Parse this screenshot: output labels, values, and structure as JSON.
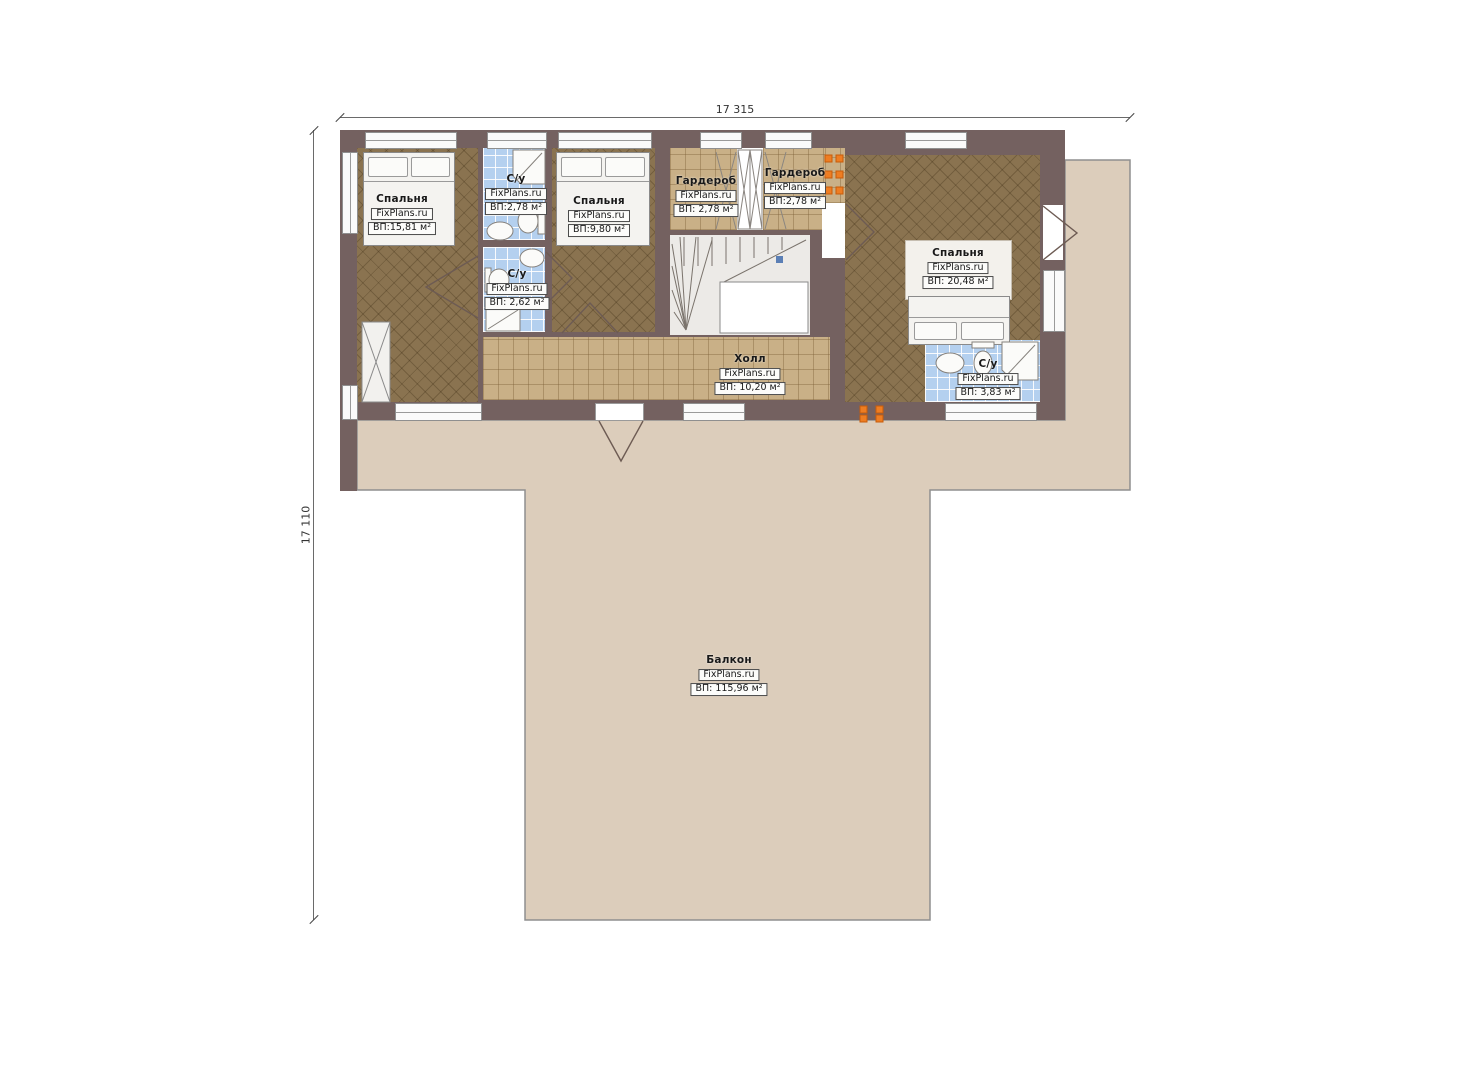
{
  "plan": {
    "source_brand": "FixPlans.ru",
    "dimensions": {
      "width_label": "17 315",
      "height_label": "17 110"
    }
  },
  "rooms": [
    {
      "id": "bedroom-1",
      "name": "Спальня",
      "brand": "FixPlans.ru",
      "area": "ВП:15,81 м²"
    },
    {
      "id": "bathroom-top",
      "name": "С/у",
      "brand": "FixPlans.ru",
      "area": "ВП:2,78 м²"
    },
    {
      "id": "bedroom-2",
      "name": "Спальня",
      "brand": "FixPlans.ru",
      "area": "ВП:9,80 м²"
    },
    {
      "id": "wardrobe-1",
      "name": "Гардероб",
      "brand": "FixPlans.ru",
      "area": "ВП: 2,78 м²"
    },
    {
      "id": "wardrobe-2",
      "name": "Гардероб",
      "brand": "FixPlans.ru",
      "area": "ВП:2,78 м²"
    },
    {
      "id": "bedroom-3",
      "name": "Спальня",
      "brand": "FixPlans.ru",
      "area": "ВП: 20,48 м²"
    },
    {
      "id": "bathroom-mid",
      "name": "С/у",
      "brand": "FixPlans.ru",
      "area": "ВП: 2,62 м²"
    },
    {
      "id": "hall",
      "name": "Холл",
      "brand": "FixPlans.ru",
      "area": "ВП: 10,20 м²"
    },
    {
      "id": "bathroom-right",
      "name": "С/у",
      "brand": "FixPlans.ru",
      "area": "ВП: 3,83 м²"
    },
    {
      "id": "balcony",
      "name": "Балкон",
      "brand": "FixPlans.ru",
      "area": "ВП: 115,96 м²"
    }
  ],
  "colors": {
    "wall": "#746160",
    "wood_floor": "#8a7350",
    "tile_floor_tan": "#c9b087",
    "tile_floor_blue": "#b4d0ef",
    "balcony": "#dccdbb",
    "accent_orange": "#ee7d22"
  }
}
